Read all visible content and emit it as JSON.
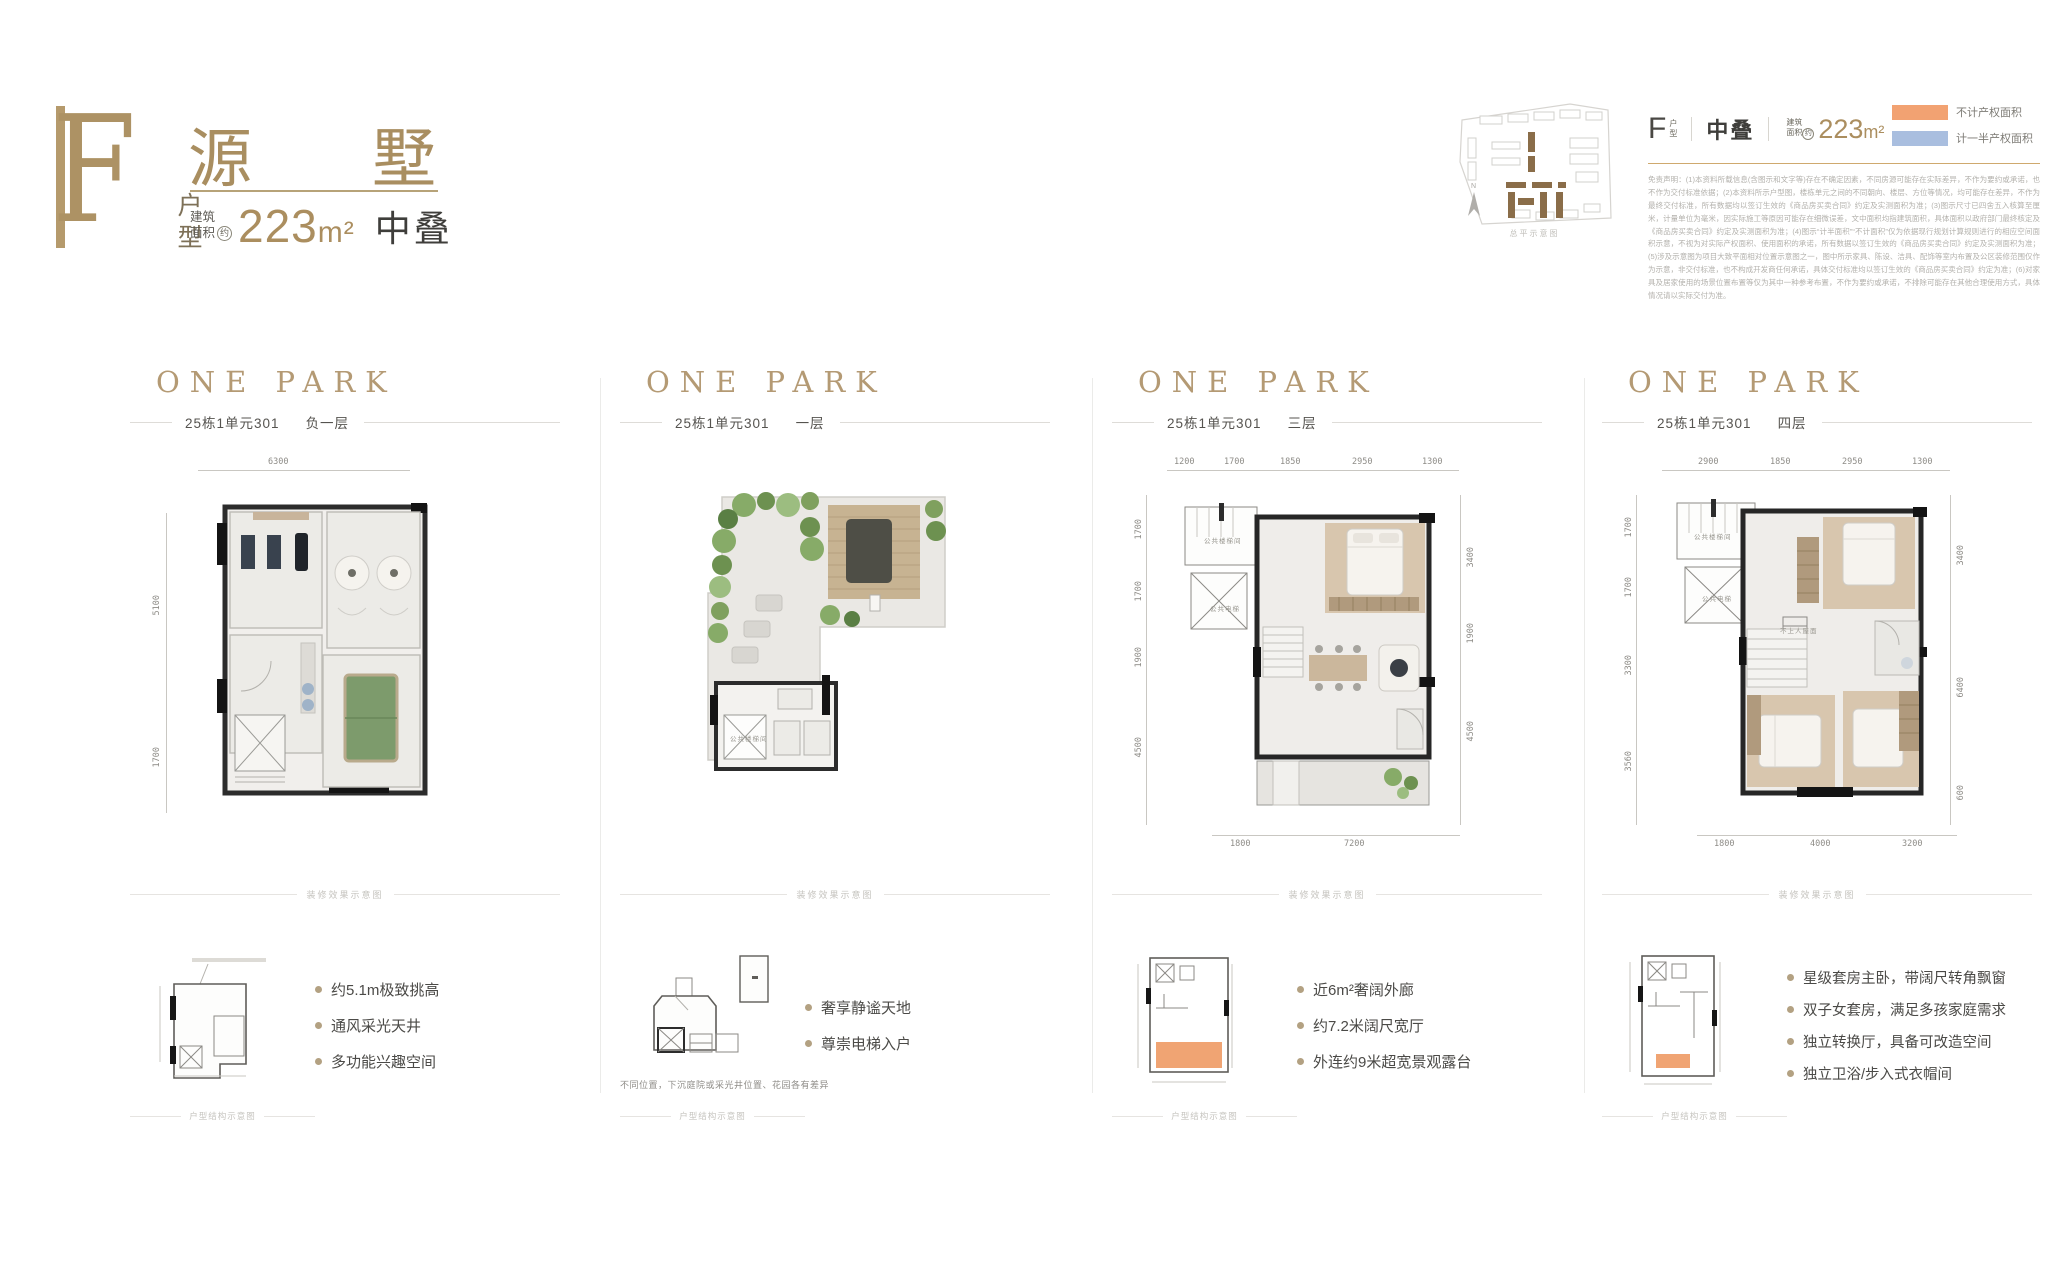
{
  "header": {
    "type_letter": "F",
    "type_label": "户型",
    "name_char_1": "源",
    "name_char_2": "墅",
    "area_label_line1": "建筑",
    "area_label_line2": "面积",
    "area_approx": "约",
    "area_value": "223",
    "area_unit": "m²",
    "stack_label": "中叠"
  },
  "info_bar": {
    "type_letter": "F",
    "type_label_top": "户",
    "type_label_bottom": "型",
    "stack_label": "中叠",
    "area_label_line1": "建筑",
    "area_label_line2": "面积",
    "area_approx": "约",
    "area_value": "223",
    "area_unit": "m²",
    "siteplan_caption": "总平示意图",
    "legend": [
      {
        "label": "不计产权面积",
        "color": "#f2a272"
      },
      {
        "label": "计一半产权面积",
        "color": "#a9bedf"
      }
    ],
    "disclaimer": "免责声明：(1)本资料所载信息(含图示和文字等)存在不确定因素，不同房源可能存在实际差异，不作为要约或承诺，也不作为交付标准依据；(2)本资料所示户型图，楼栋单元之间的不同朝向、楼层、方位等情况，均可能存在差异，不作为最终交付标准，所有数据均以签订生效的《商品房买卖合同》约定及实测面积为准；(3)图示尺寸已四舍五入核算至厘米，计量单位为毫米，因实际施工等原因可能存在细微误差，文中面积均指建筑面积，具体面积以政府部门最终核定及《商品房买卖合同》约定及实测面积为准；(4)图示“计半面积”“不计面积”仅为依据现行规划计算规则进行的相应空间面积示意，不视为对实际产权面积、使用面积的承诺，所有数据以签订生效的《商品房买卖合同》约定及实测面积为准；(5)涉及示意图为项目大致平面相对位置示意图之一，图中所示家具、陈设、洁具、配饰等室内布置及公区装修范围仅作为示意，非交付标准，也不构成开发商任何承诺，具体交付标准均以签订生效的《商品房买卖合同》约定为准；(6)对家具及居家使用的场景位置布置等仅为其中一种参考布置，不作为要约或承诺，不排除可能存在其他合理使用方式，具体情况请以实际交付为准。"
  },
  "columns": [
    {
      "logo": "ONE PARK",
      "caption_unit": "25栋1单元301",
      "caption_floor": "负一层",
      "dims_top": [
        "6300"
      ],
      "dims_left": [
        "5100",
        "1700"
      ],
      "effect_caption": "装修效果示意图",
      "mini_caption": "户型结构示意图",
      "bullets": [
        "约5.1m极致挑高",
        "通风采光天井",
        "多功能兴趣空间"
      ]
    },
    {
      "logo": "ONE PARK",
      "caption_unit": "25栋1单元301",
      "caption_floor": "一层",
      "labels": [
        "公共楼梯间"
      ],
      "effect_caption": "装修效果示意图",
      "mini_caption": "户型结构示意图",
      "note": "不同位置，下沉庭院或采光井位置、花园各有差异",
      "bullets": [
        "奢享静谧天地",
        "尊崇电梯入户"
      ]
    },
    {
      "logo": "ONE PARK",
      "caption_unit": "25栋1单元301",
      "caption_floor": "三层",
      "dims_top": [
        "1200",
        "1700",
        "1850",
        "2950",
        "1300"
      ],
      "dims_left": [
        "1700",
        "1700",
        "1900",
        "4500"
      ],
      "dims_right": [
        "3400",
        "1900",
        "4500"
      ],
      "dims_bottom": [
        "1800",
        "7200"
      ],
      "labels": [
        "公共楼梯间",
        "公共电梯"
      ],
      "effect_caption": "装修效果示意图",
      "mini_caption": "户型结构示意图",
      "bullets": [
        "近6m²奢阔外廊",
        "约7.2米阔尺宽厅",
        "外连约9米超宽景观露台"
      ]
    },
    {
      "logo": "ONE PARK",
      "caption_unit": "25栋1单元301",
      "caption_floor": "四层",
      "dims_top": [
        "2900",
        "1850",
        "2950",
        "1300"
      ],
      "dims_left": [
        "1700",
        "1700",
        "3300",
        "3560"
      ],
      "dims_right": [
        "3400",
        "6400",
        "600"
      ],
      "dims_bottom": [
        "1800",
        "4000",
        "3200"
      ],
      "labels": [
        "公共楼梯间",
        "公共电梯",
        "不上人屋面"
      ],
      "effect_caption": "装修效果示意图",
      "mini_caption": "户型结构示意图",
      "bullets": [
        "星级套房主卧，带阔尺转角飘窗",
        "双子女套房，满足多孩家庭需求",
        "独立转换厅，具备可改造空间",
        "独立卫浴/步入式衣帽间"
      ]
    }
  ]
}
